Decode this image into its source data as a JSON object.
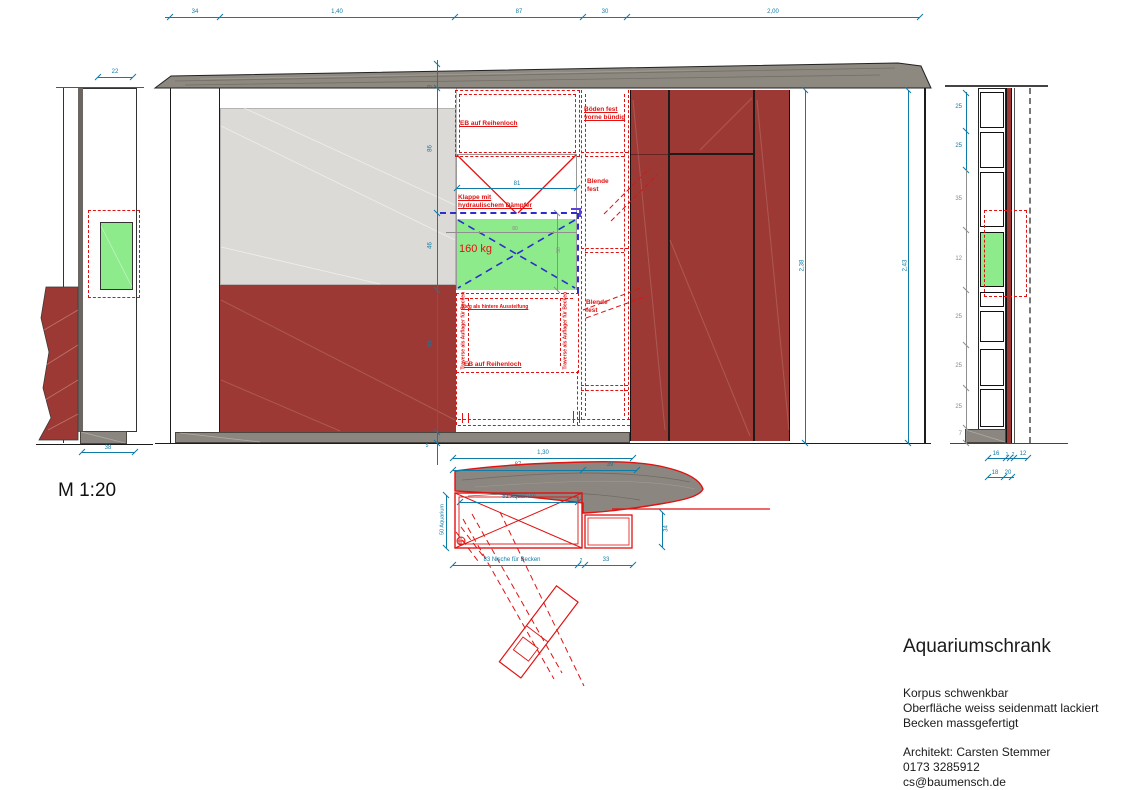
{
  "scale_label": "M 1:20",
  "title_block": {
    "title": "Aquariumschrank",
    "lines": [
      "Korpus schwenkbar",
      "Oberfläche weiss seidenmatt lackiert",
      "Becken massgefertigt"
    ],
    "architect": [
      "Architekt: Carsten Stemmer",
      "0173 3285912",
      "cs@baumensch.de"
    ]
  },
  "colors": {
    "dimension_teal": "#0e7ca6",
    "annotation_red": "#e01212",
    "cabinet_dark_red": "#9d3934",
    "flap_green": "#8deb8b",
    "panel_light_gray": "#dbdad6",
    "wood_gray": "#8b867f",
    "hidden_line_blue": "#2d2dcf"
  },
  "front": {
    "top_dims": [
      "34",
      "1,40",
      "87",
      "30",
      "2,00"
    ],
    "left_height_dims": [
      "8",
      "86",
      "46",
      "96",
      "5"
    ],
    "right_height_dims": [
      "2,38",
      "2,43"
    ],
    "flap": {
      "width_dim": "81",
      "inner_width_dim": "80",
      "inner_height_dim": "50",
      "weight": "160 kg",
      "klappe_1": "Klappe mit",
      "klappe_2": "hydraulischem Dämpfer"
    },
    "annotations": {
      "eb": "EB auf Reihenloch",
      "boeden_1": "Böden fest",
      "boeden_2": "vorne bündig",
      "blende_1": "Blende",
      "blende_2": "fest",
      "steg": "Steg als hintere Aussteifung",
      "traverse": "Traverse als Auflager für Becken"
    }
  },
  "left_view": {
    "top_dim": "22",
    "bottom_dim": "38"
  },
  "right_view": {
    "teal_dims": [
      "25",
      "25"
    ],
    "gray_dims": [
      "35",
      "12",
      "25",
      "25",
      "25",
      "7"
    ],
    "bottom_row1": [
      "16",
      "1",
      "2",
      "12"
    ],
    "bottom_row2": [
      "18",
      "20"
    ]
  },
  "plan": {
    "dim_130": "1,30",
    "dim_87": "87",
    "dim_39": "39",
    "aquarium_width": "82 Aquarium",
    "aquarium_depth": "50 Aquarium",
    "dim_34": "34",
    "niche_label": "83 Nische für Becken",
    "dim_2": "2",
    "dim_33": "33"
  }
}
